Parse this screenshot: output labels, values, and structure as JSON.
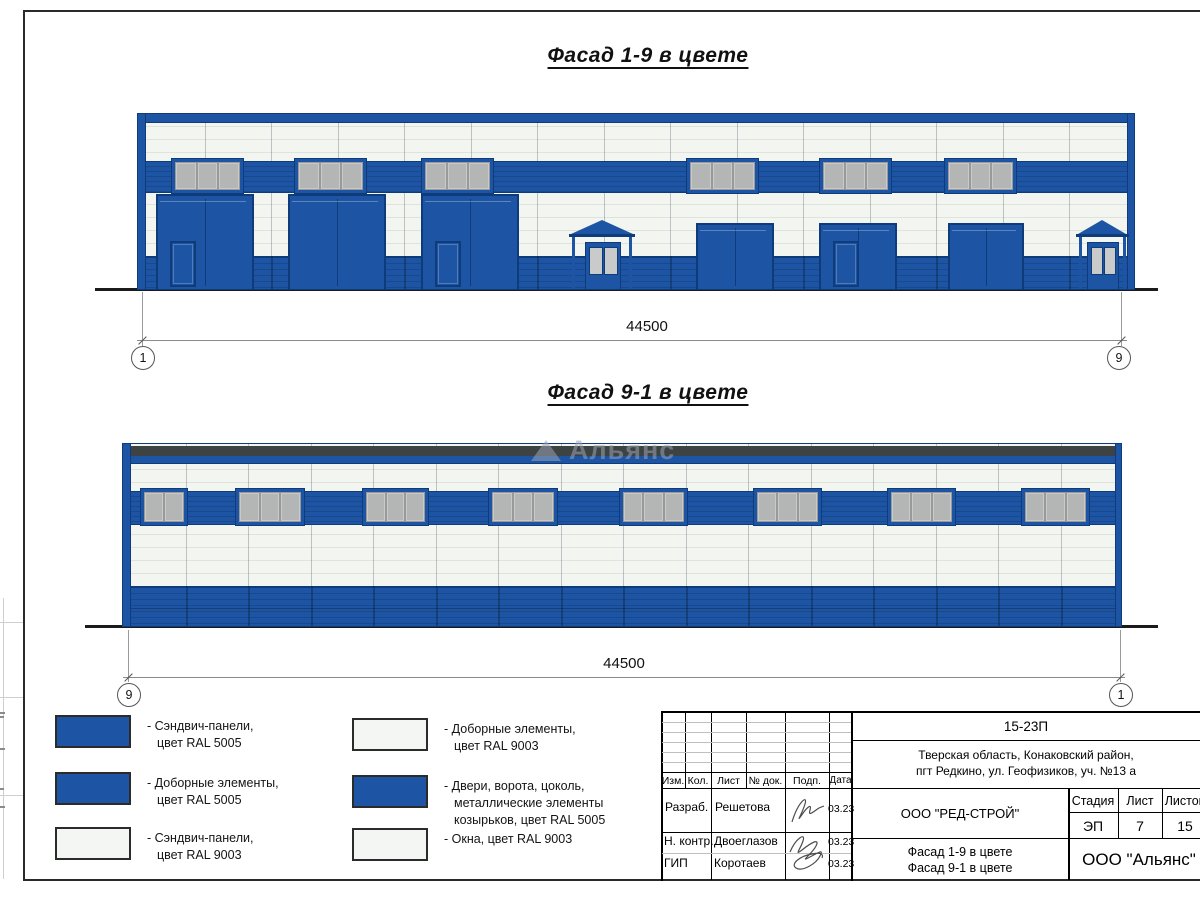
{
  "colors": {
    "blue": "#1d55a4",
    "blue_dark": "#0e3c7b",
    "panel_white": "#f3f6f0",
    "panel_line": "#dee4db",
    "window_gray": "#b4b6b5",
    "roof_dark": "#3d4242",
    "ground": "#1b1b1b"
  },
  "titles": {
    "facade_top": "Фасад 1-9 в цвете",
    "facade_bottom": "Фасад 9-1 в цвете"
  },
  "watermark": "Альянс",
  "dimensions": {
    "top": {
      "value": "44500",
      "axis_left": "1",
      "axis_right": "9"
    },
    "bottom": {
      "value": "44500",
      "axis_left": "9",
      "axis_right": "1"
    }
  },
  "legend": [
    {
      "col": 1,
      "swatch": "blue",
      "lines": [
        "- Сэндвич-панели,",
        "цвет RAL 5005"
      ]
    },
    {
      "col": 1,
      "swatch": "blue",
      "lines": [
        "- Доборные элементы,",
        "цвет RAL 5005"
      ]
    },
    {
      "col": 1,
      "swatch": "white",
      "lines": [
        "- Сэндвич-панели,",
        "цвет RAL 9003"
      ]
    },
    {
      "col": 2,
      "swatch": "white",
      "lines": [
        "- Доборные элементы,",
        "цвет RAL 9003"
      ]
    },
    {
      "col": 2,
      "swatch": "blue",
      "lines": [
        "- Двери, ворота, цоколь,",
        "металлические элементы",
        "козырьков, цвет RAL 5005"
      ]
    },
    {
      "col": 2,
      "swatch": "white",
      "lines": [
        "- Окна, цвет RAL 9003"
      ]
    }
  ],
  "title_block": {
    "doc_number": "15-23П",
    "address_line1": "Тверская область, Конаковский район,",
    "address_line2": "пгт Редкино, ул. Геофизиков, уч. №13 а",
    "contractor": "ООО \"РЕД-СТРОЙ\"",
    "subject_line1": "Фасад 1-9 в цвете",
    "subject_line2": "Фасад 9-1 в цвете",
    "organization": "ООО \"Альянс\"",
    "stage_label": "Стадия",
    "sheet_label": "Лист",
    "sheets_label": "Листов",
    "stage": "ЭП",
    "sheet": "7",
    "sheets": "15",
    "col_izm": "Изм.",
    "col_kol": "Кол.",
    "col_list": "Лист",
    "col_doc": "№ док.",
    "col_podp": "Подп.",
    "col_data": "Дата",
    "rows": [
      {
        "role": "Разраб.",
        "name": "Решетова",
        "date": "03.23"
      },
      {
        "role": "Н. контр.",
        "name": "Двоеглазов",
        "date": "03.23"
      },
      {
        "role": "ГИП",
        "name": "Коротаев",
        "date": "03.23"
      }
    ]
  },
  "facade_top_spec": {
    "x": 137,
    "y": 113,
    "w": 998,
    "h": 177,
    "bays": 15,
    "top_band_h": 8,
    "window_band": {
      "y": 47,
      "h": 30
    },
    "window": {
      "y": 44,
      "h": 36,
      "panes": 3
    },
    "window_w": 73,
    "windows_x": [
      33,
      156,
      283,
      548,
      681,
      806
    ],
    "plinth_y": 142,
    "gate_y": 80,
    "gates": [
      {
        "x": 18,
        "w": 98,
        "wicket": true
      },
      {
        "x": 150,
        "w": 98,
        "wicket": false
      },
      {
        "x": 283,
        "w": 98,
        "wicket": true
      }
    ],
    "door_y": 109,
    "doors": [
      {
        "x": 558,
        "w": 78,
        "wicket": false
      },
      {
        "x": 681,
        "w": 78,
        "wicket": true
      },
      {
        "x": 810,
        "w": 76,
        "wicket": false
      }
    ],
    "entrances": [
      {
        "x": 433,
        "w": 62,
        "door_x": 447,
        "door_w": 36
      },
      {
        "x": 940,
        "w": 49,
        "door_x": 949,
        "door_w": 32
      }
    ]
  },
  "facade_bottom_spec": {
    "x": 122,
    "y": 443,
    "w": 1000,
    "h": 184,
    "bays": 16,
    "roof": {
      "y": 2,
      "h": 10
    },
    "blue_top": {
      "y": 12,
      "h": 7
    },
    "window_band": {
      "y": 47,
      "h": 32
    },
    "window": {
      "y": 44,
      "h": 38
    },
    "windows": [
      {
        "x": 17,
        "w": 48,
        "panes": 2
      },
      {
        "x": 112,
        "w": 70,
        "panes": 3
      },
      {
        "x": 239,
        "w": 67,
        "panes": 3
      },
      {
        "x": 365,
        "w": 70,
        "panes": 3
      },
      {
        "x": 496,
        "w": 69,
        "panes": 3
      },
      {
        "x": 630,
        "w": 69,
        "panes": 3
      },
      {
        "x": 764,
        "w": 69,
        "panes": 3
      },
      {
        "x": 898,
        "w": 69,
        "panes": 3
      }
    ],
    "bottom_blue_y": 142
  }
}
